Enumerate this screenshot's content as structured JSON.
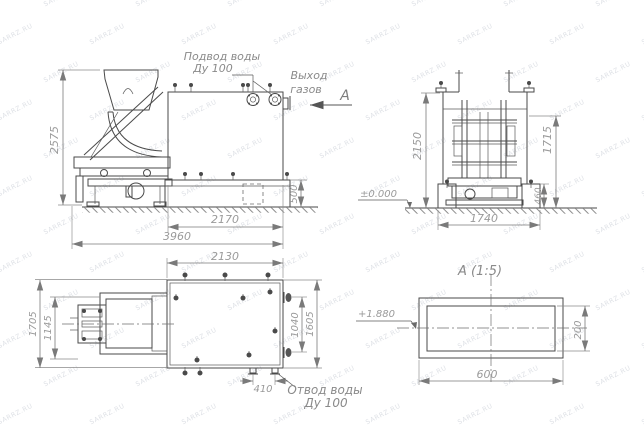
{
  "watermark": {
    "text": "SARRZ.RU"
  },
  "colors": {
    "background": "#ffffff",
    "main_line": "#4a4a4a",
    "dimension_line": "#7a7a7a",
    "dimension_text": "#9a9a9a",
    "label_text": "#8a8a8a",
    "watermark": "#c4c9d2"
  },
  "labels": {
    "water_supply_1": "Подвод воды",
    "water_supply_2": "Ду 100",
    "gas_1": "Выход",
    "gas_2": "газов",
    "view_mark": "А",
    "elev_zero": "±0.000",
    "elev_duct": "+1.880",
    "drain_1": "Отвод воды",
    "drain_2": "Ду 100",
    "section_title": "А  (1:5)"
  },
  "dimensions": {
    "front": {
      "overall_height": "2575",
      "tank_length": "2170",
      "overall_length": "3960",
      "base_height": "500"
    },
    "side": {
      "overall_height": "2150",
      "tank_height": "1715",
      "base_height": "460",
      "foundation_width": "1740"
    },
    "plan": {
      "tank_length": "2130",
      "overall_width": "1705",
      "skip_width": "1145",
      "nozzle_spacing": "1040",
      "nozzle_span": "1605",
      "drain_spacing": "410"
    },
    "section": {
      "duct_width": "600",
      "duct_height": "200"
    }
  }
}
